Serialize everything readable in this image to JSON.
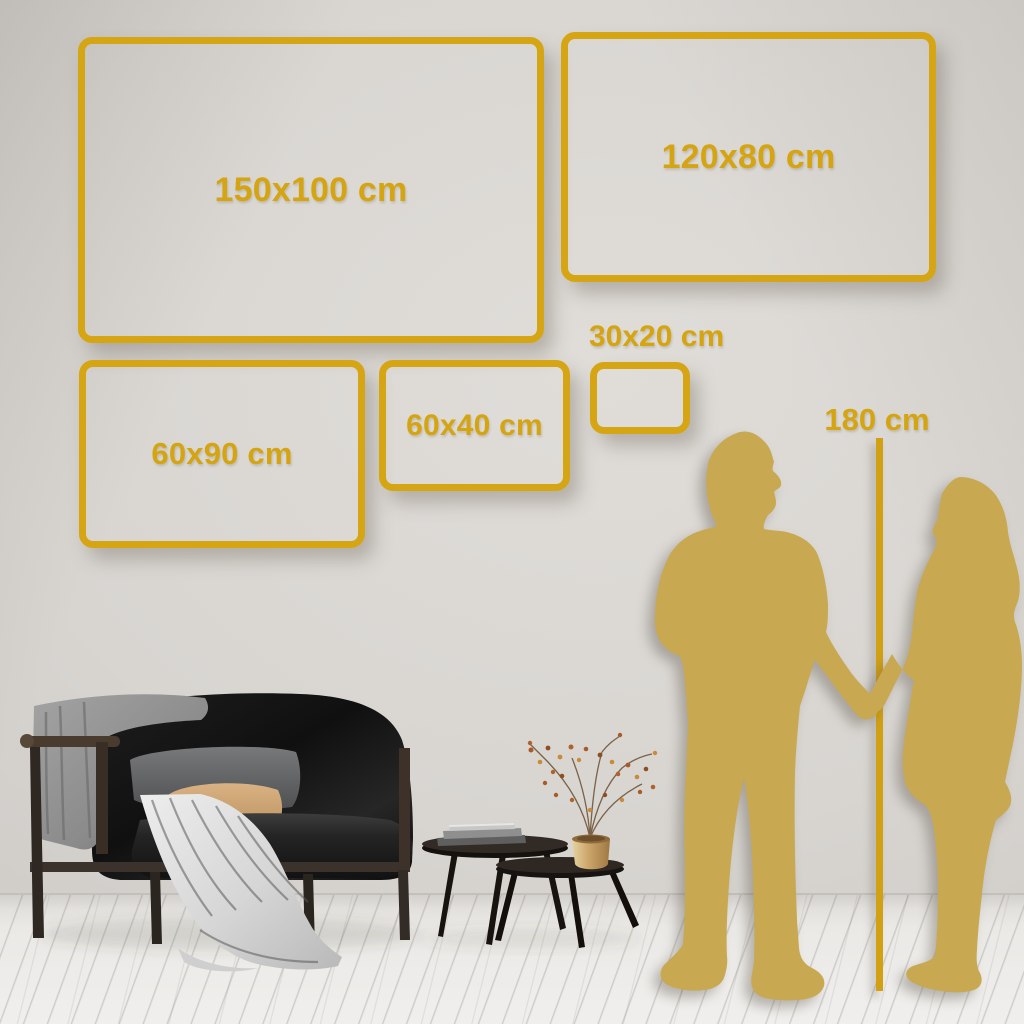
{
  "sizes": {
    "s150x100": "150x100 cm",
    "s120x80": "120x80 cm",
    "s60x90": "60x90 cm",
    "s60x40": "60x40 cm",
    "s30x20": "30x20 cm"
  },
  "reference": {
    "person_height": "180 cm"
  },
  "colors": {
    "gold_accent": "#d5a513",
    "gold_text": "#d5a411",
    "silhouette_gold": "#c8a851",
    "wall": "#d7d4d0",
    "floor": "#edebe8",
    "sofa_black": "#161616",
    "blanket_gray": "#909090",
    "pillow_beige": "#cda571",
    "vase_brass": "#c9a060",
    "berries_rust": "#b0622c"
  },
  "scene": {
    "figures": [
      "man-silhouette",
      "woman-silhouette"
    ],
    "furniture": [
      "black-loveseat-sofa",
      "gray-blanket",
      "gray-back-cushion",
      "beige-pillow",
      "white-throw-cloth",
      "round-coffee-table-large",
      "round-coffee-table-small",
      "books-stack",
      "brass-vase",
      "dried-branches"
    ]
  }
}
